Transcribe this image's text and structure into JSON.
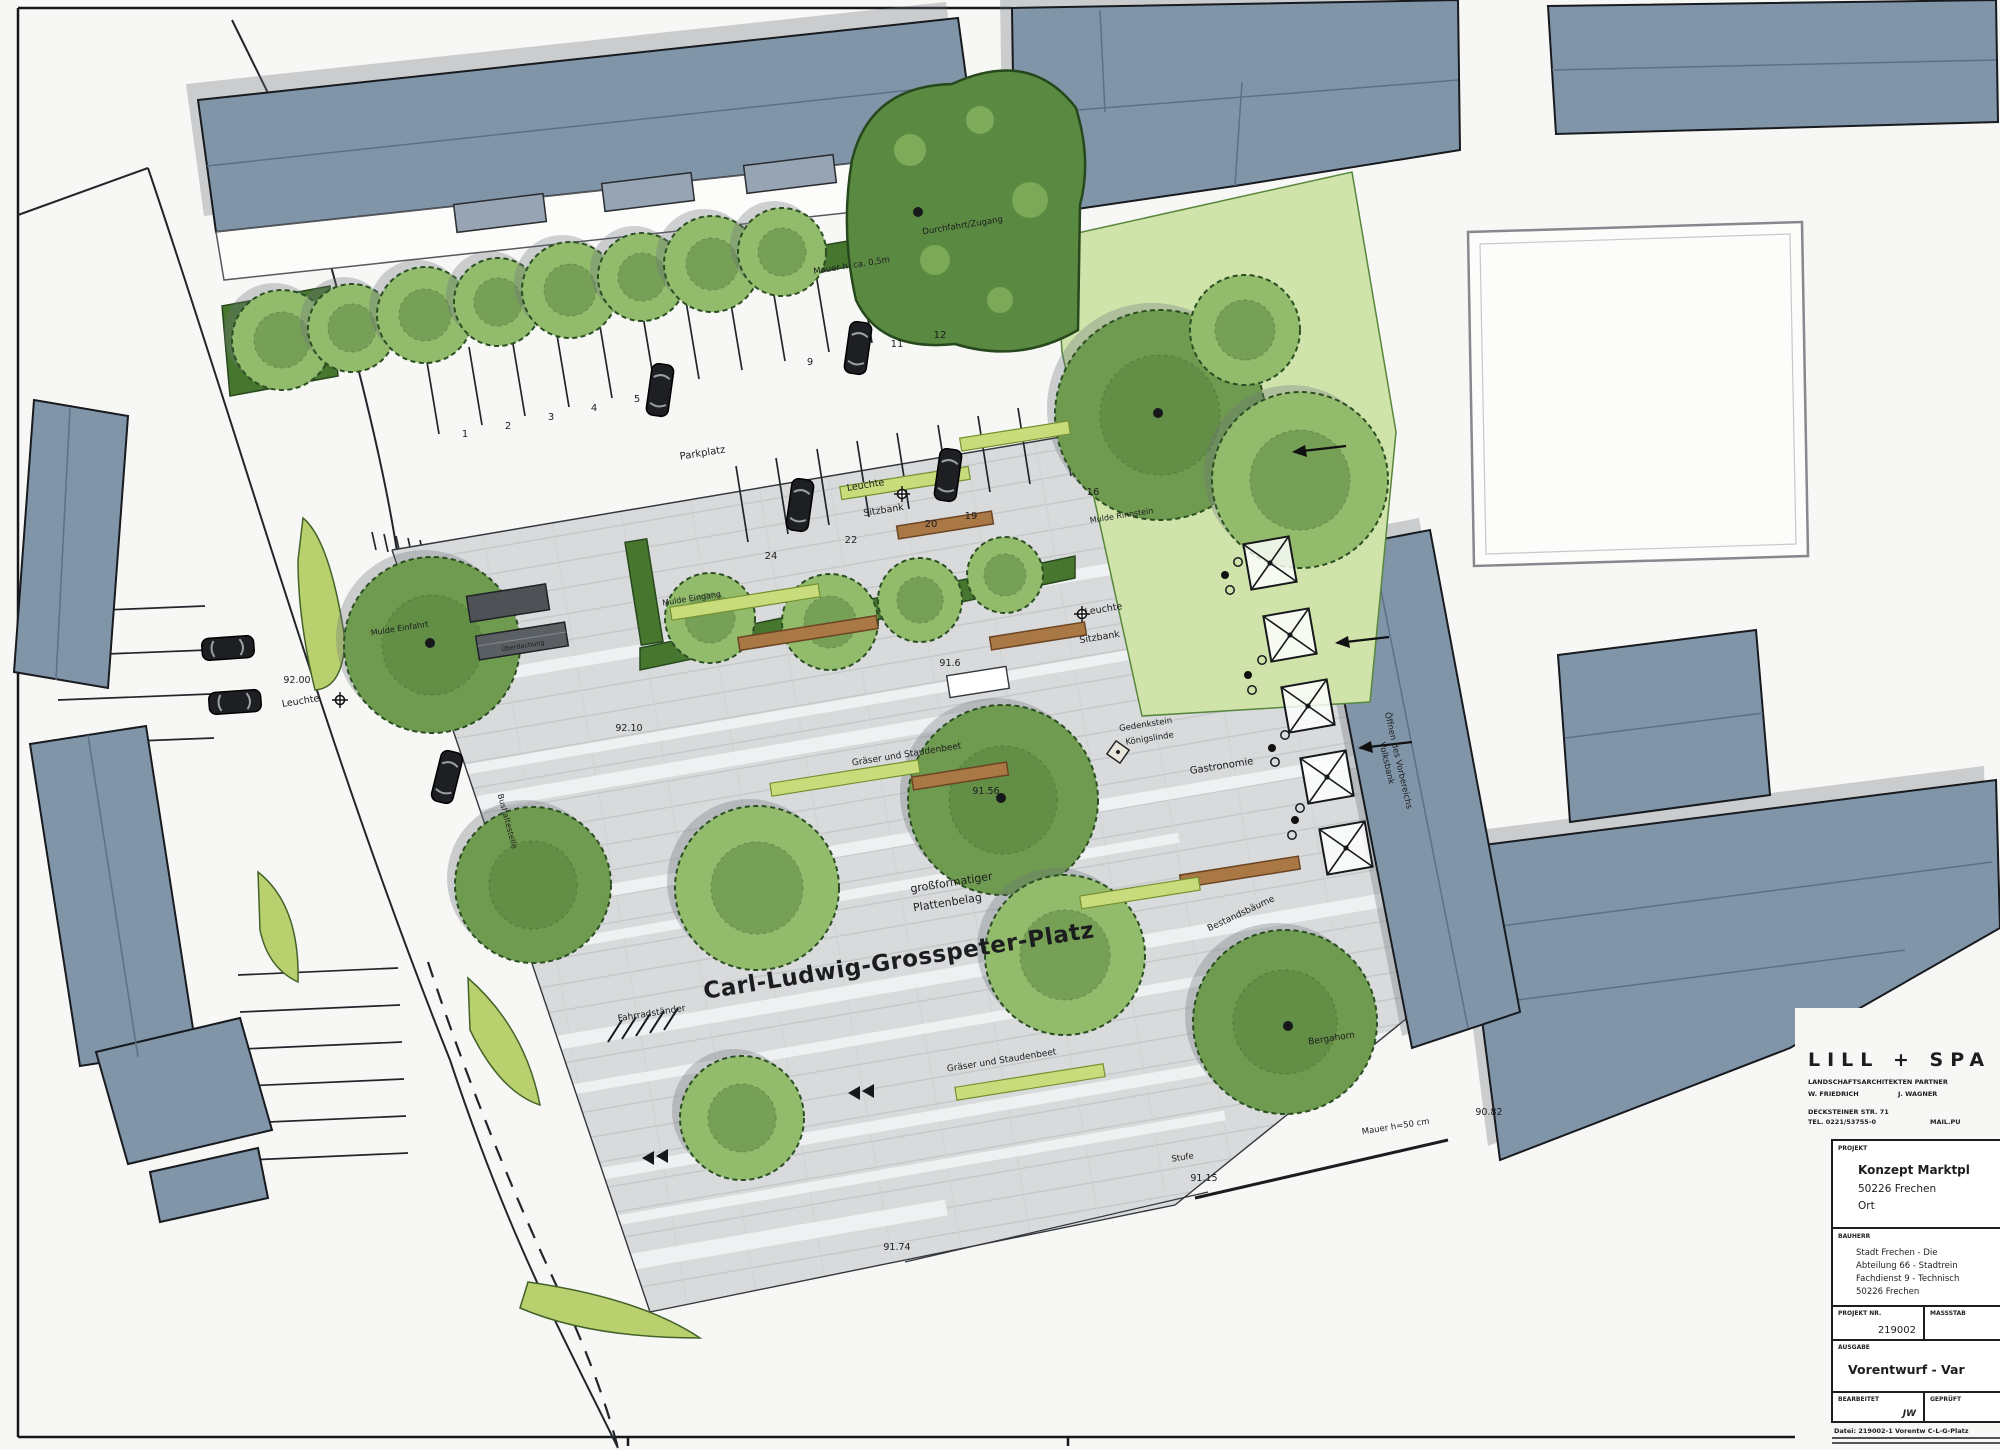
{
  "sheet": {
    "plaza_name": "Carl-Ludwig-Grosspeter-Platz",
    "labels": {
      "balkon": "Balkon",
      "durchfahrt": "Durchfahrt/Zugang",
      "mauer_hoehe": "Mauer h. ca. 0,5m",
      "parkplatz": "Parkplatz",
      "mulde_einfahrt": "Mulde Einfahrt",
      "mulde_eingang": "Mulde Eingang",
      "mulde_rinnstein": "Mulde Rinnstein",
      "leuchte": "Leuchte",
      "sitzbank": "Sitzbank",
      "graeser_stauden": "Gräser und Staudenbeet",
      "gedenkstein_l1": "Gedenkstein",
      "gedenkstein_l2": "Königslinde",
      "gastronomie": "Gastronomie",
      "plattenbelag_l1": "großformatiger",
      "plattenbelag_l2": "Plattenbelag",
      "fahrradstaender": "Fahrradständer",
      "bestandsbaeume": "Bestandsbäume",
      "bergahorn": "Bergahorn",
      "stufe": "Stufe",
      "mauer_50": "Mauer h=50 cm",
      "bushaltestelle": "Bushaltestelle",
      "ueberdachung": "Überdachung",
      "volksbank_l1": "Öffnen des Vorbereichs",
      "volksbank_l2": "Volksbank"
    },
    "elevations": {
      "p9200": "92.00",
      "p9210": "92.10",
      "p9156": "91.56",
      "p9160": "91.6",
      "p9115": "91.15",
      "p9082": "90.82",
      "p9174": "91.74"
    },
    "parking": {
      "row1": [
        "1",
        "2",
        "3",
        "4",
        "5",
        "9",
        "11",
        "12"
      ],
      "row2": [
        "24",
        "22",
        "20",
        "19",
        "16"
      ]
    }
  },
  "title_block": {
    "firm": "LILL + SPA",
    "firm_type": "LANDSCHAFTSARCHITEKTEN PARTNER",
    "partner_left": "W. FRIEDRICH",
    "partner_right": "J. WAGNER",
    "address": "DECKSTEINER STR. 71",
    "phone": "TEL. 0221/53755-0",
    "phone_right": "MAIL.PU",
    "project_header": "PROJEKT",
    "project_name": "Konzept Marktpl",
    "project_city": "50226 Frechen",
    "project_line3": "Ort",
    "client_header": "BAUHERR",
    "client_line1": "Stadt Frechen - Die",
    "client_line2": "Abteilung 66 - Stadtrein",
    "client_line3": "Fachdienst 9 - Technisch",
    "client_line4": "50226 Frechen",
    "projectno_header": "PROJEKT NR.",
    "projectno_value": "219002",
    "scale_header": "MASSSTAB",
    "issue_header": "AUSGABE",
    "issue_value": "Vorentwurf - Var",
    "drawn_header": "BEARBEITET",
    "drawn_value": "JW",
    "checked_header": "GEPRÜFT",
    "file_note": "Datei: 219002-1 Vorentw C-L-G-Platz"
  }
}
